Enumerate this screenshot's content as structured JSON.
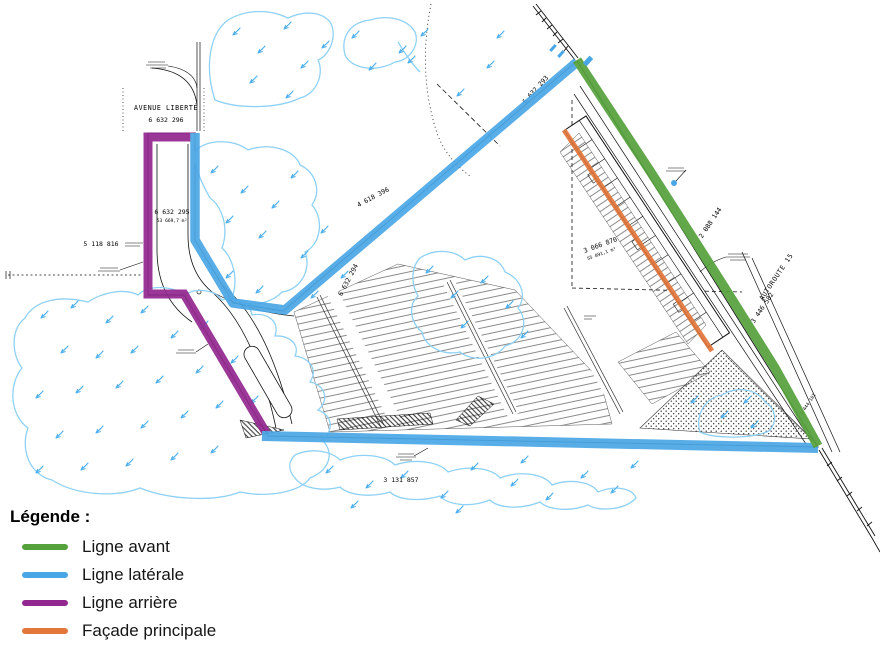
{
  "colors": {
    "front": "#55a13c",
    "lateral": "#4aa7e6",
    "rear": "#92278f",
    "facade": "#e2763b"
  },
  "legend": {
    "title": "Légende :",
    "items": [
      {
        "id": "front",
        "label": "Ligne avant"
      },
      {
        "id": "lateral",
        "label": "Ligne latérale"
      },
      {
        "id": "rear",
        "label": "Ligne arrière"
      },
      {
        "id": "facade",
        "label": "Façade principale"
      }
    ]
  },
  "map": {
    "street_label": "AVENUE LIBERTÉ",
    "highway_label": "AUTOROUTE 15",
    "lots": {
      "lot_6632296": "6 632 296",
      "lot_6632295": "6 632 295",
      "lot_6632295_area": "53 669,7 m²",
      "lot_5118816": "5 118 816",
      "lot_4618396": "4 618 396",
      "lot_6632294": "6 632 294",
      "lot_3066870": "3 066 870",
      "lot_3066870_area": "55 091,1 m²",
      "lot_6632293": "6 632 293",
      "lot_2088144": "2 088 144",
      "lot_3446582": "3 446 582",
      "lot_3444181": "3 444 181",
      "lot_3131857": "3 131 857"
    }
  }
}
